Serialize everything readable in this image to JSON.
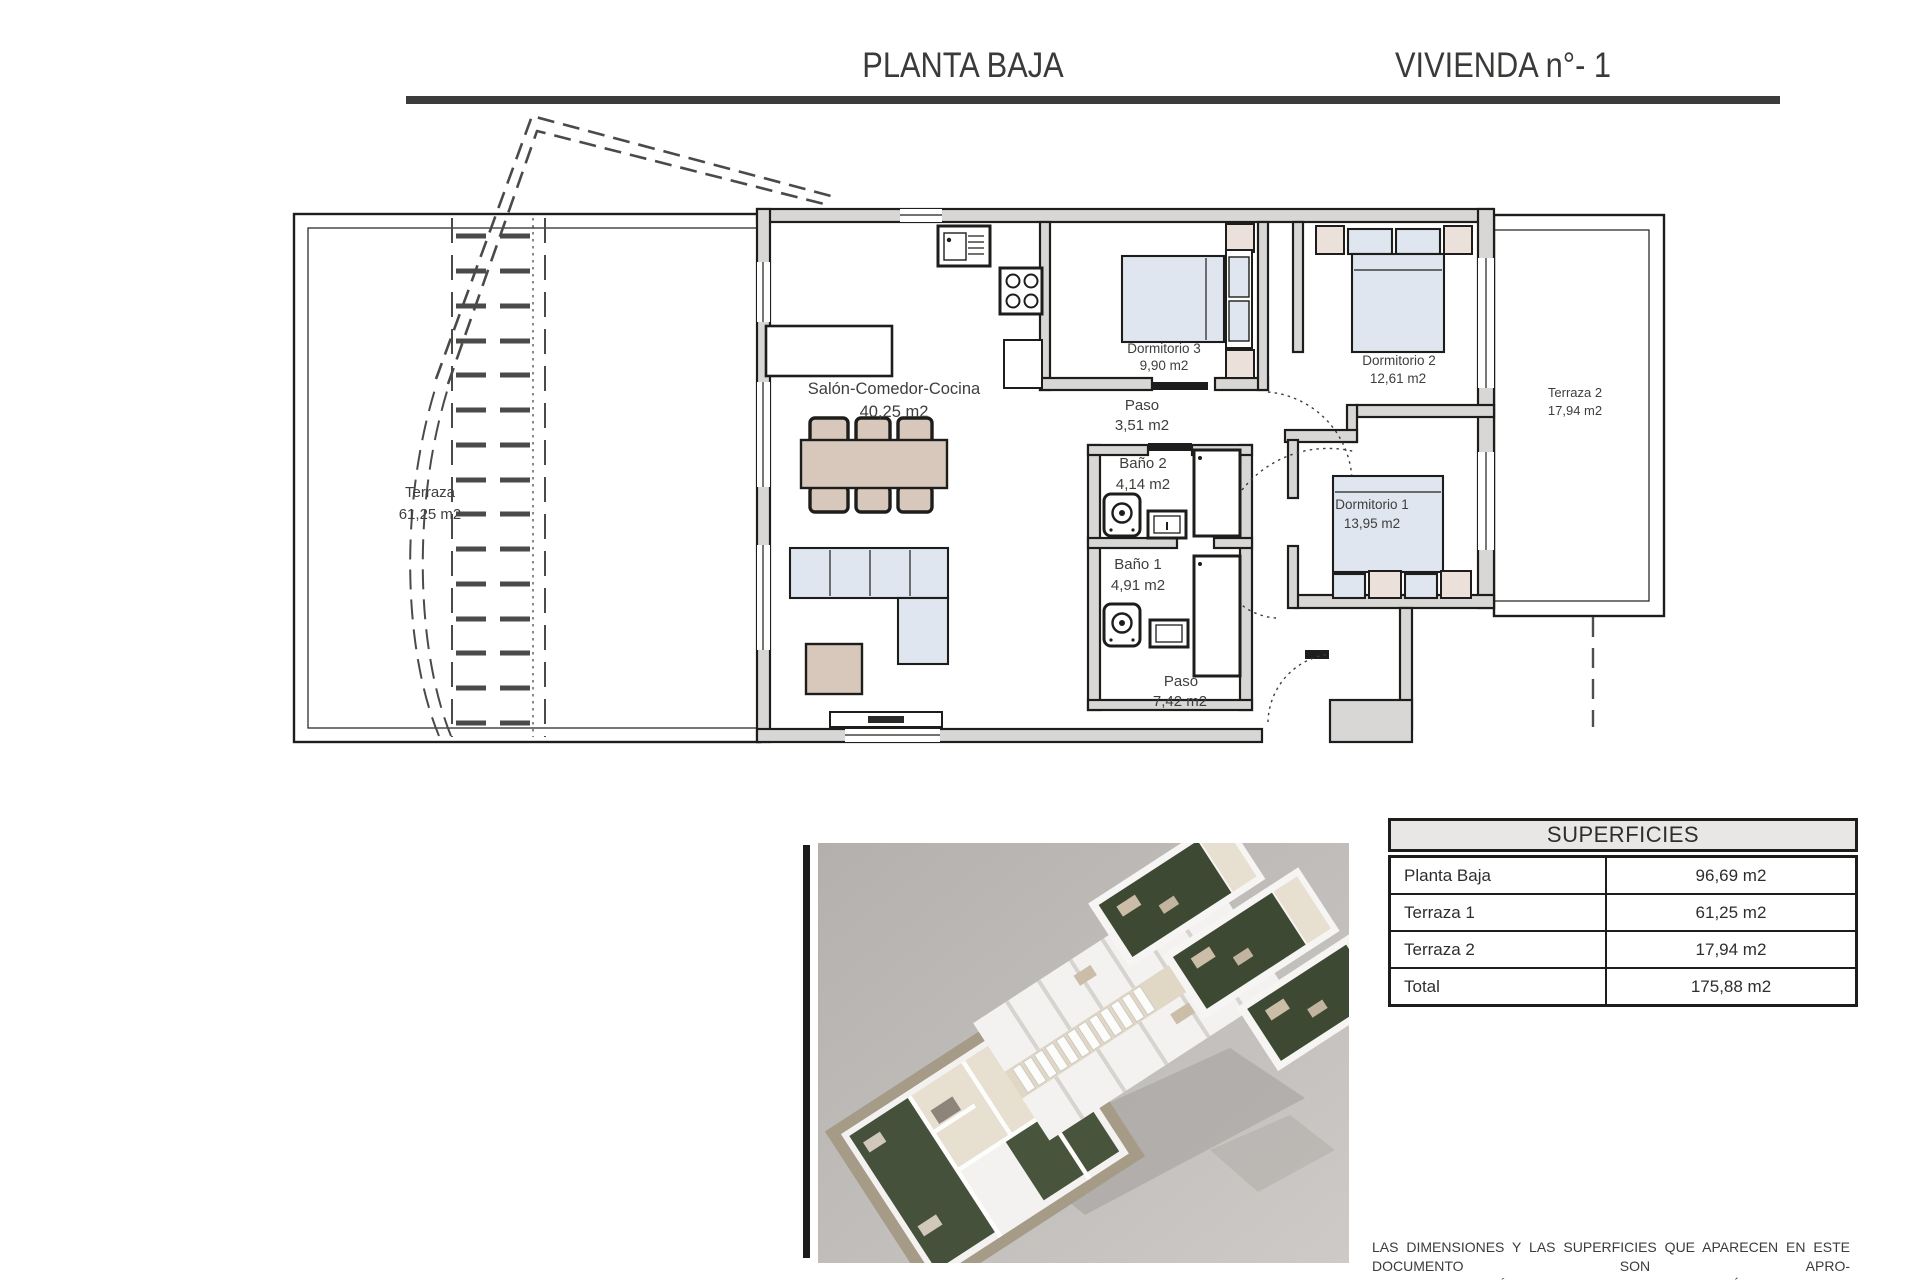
{
  "header": {
    "title_left": "PLANTA BAJA",
    "title_right": "VIVIENDA n°- 1"
  },
  "rooms": {
    "terraza1": {
      "name": "Terraza",
      "area": "61,25 m2"
    },
    "salon": {
      "name": "Salón-Comedor-Cocina",
      "area": "40,25 m2"
    },
    "dormitorio3": {
      "name": "Dormitorio 3",
      "area": "9,90 m2"
    },
    "paso1": {
      "name": "Paso",
      "area": "3,51 m2"
    },
    "dormitorio2": {
      "name": "Dormitorio 2",
      "area": "12,61 m2"
    },
    "terraza2": {
      "name": "Terraza 2",
      "area": "17,94 m2"
    },
    "bano2": {
      "name": "Baño 2",
      "area": "4,14 m2"
    },
    "bano1": {
      "name": "Baño 1",
      "area": "4,91 m2"
    },
    "dormitorio1": {
      "name": "Dormitorio 1",
      "area": "13,95 m2"
    },
    "paso2": {
      "name": "Paso",
      "area": "7,42 m2"
    }
  },
  "superficies": {
    "title": "SUPERFICIES",
    "rows": [
      {
        "label": "Planta Baja",
        "value": "96,69 m2"
      },
      {
        "label": "Terraza 1",
        "value": "61,25 m2"
      },
      {
        "label": "Terraza 2",
        "value": "17,94 m2"
      },
      {
        "label": "Total",
        "value": "175,88 m2"
      }
    ]
  },
  "disclaimer": {
    "line1": "LAS DIMENSIONES Y LAS SUPERFICIES QUE APARECEN EN ESTE DOCUMENTO SON APRO-",
    "line2": "XIMADAS Y PODRÁN SER OBJETO DE MODIFICACIÓN DURANTE LA REDACCIÓN DE LOS",
    "line3": "PROYECTOS BÁSICO Y DE EJECUCIÓN"
  },
  "colors": {
    "ink": "#1d1d1b",
    "wall_gray": "#d9d7d5",
    "furniture_tan": "#d7c8bb",
    "furniture_blue": "#dfe6ef",
    "soft_beige": "#ece1da",
    "render_background": "#c3c0bd",
    "render_turf_green": "#3e4933",
    "title_color": "#3a3a38"
  }
}
